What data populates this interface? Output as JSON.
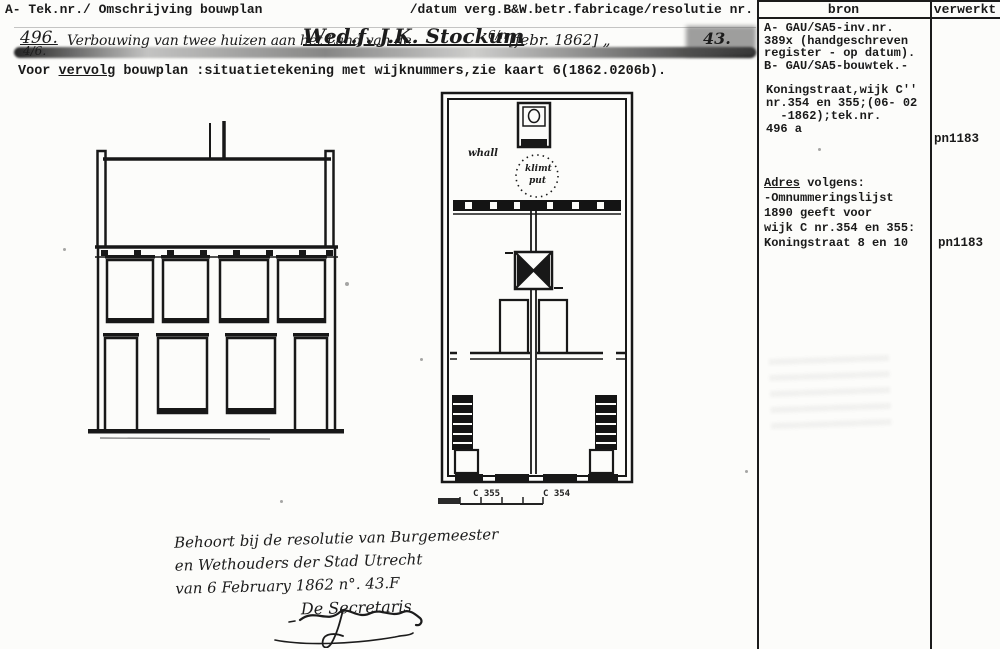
{
  "colors": {
    "paper": "#fcfcfa",
    "ink": "#161616"
  },
  "header": {
    "left": "A- Tek.nr./ Omschrijving bouwplan",
    "right": "/datum verg.B&W.betr.fabricage/resolutie nr."
  },
  "sidebar": {
    "bron_header": "bron",
    "verwerkt_header": "verwerkt",
    "bron_block_a": [
      "A- GAU/SA5-inv.nr.",
      "389x (handgeschreven",
      "register - op datum).",
      "B- GAU/SA5-bouwtek.-"
    ],
    "bron_block_b": [
      "Koningstraat,wijk C''",
      "nr.354 en 355;(06- 02",
      "  -1862);tek.nr.",
      "496 a"
    ],
    "adres_label": "Adres",
    "adres_rest": " volgens:",
    "adres_lines": [
      "-Omnummeringslijst",
      "1890 geeft voor",
      "wijk C nr.354 en 355:",
      "Koningstraat 8 en 10"
    ],
    "verwerkt_1": "pn1183",
    "verwerkt_2": "pn1183"
  },
  "registration": {
    "number": "496.",
    "sub_number": "4/6.",
    "description": "Verbouwing van twee huizen aan het Land van de",
    "name": "Wed.f. J.K. Stockum",
    "name_suffix": "6/n",
    "date": "[febr. 1862] „",
    "resolution_nr": "43."
  },
  "note": {
    "prefix": "Voor ",
    "underlined": "vervolg",
    "rest": " bouwplan :situatietekening met wijknummers,zie kaart 6(1862.0206b)."
  },
  "plan_annotations": {
    "room_note": "whall",
    "well_note_line1": "klimt",
    "well_note_line2": "put",
    "label_left_house": "C 355",
    "label_right_house": "C 354"
  },
  "resolution_note": {
    "line1": "Behoort bij de resolutie van Burgemeester",
    "line2": "en Wethouders der Stad Utrecht",
    "line3": "van 6 February 1862 n°. 43.F",
    "line4": "De Secretaris"
  }
}
